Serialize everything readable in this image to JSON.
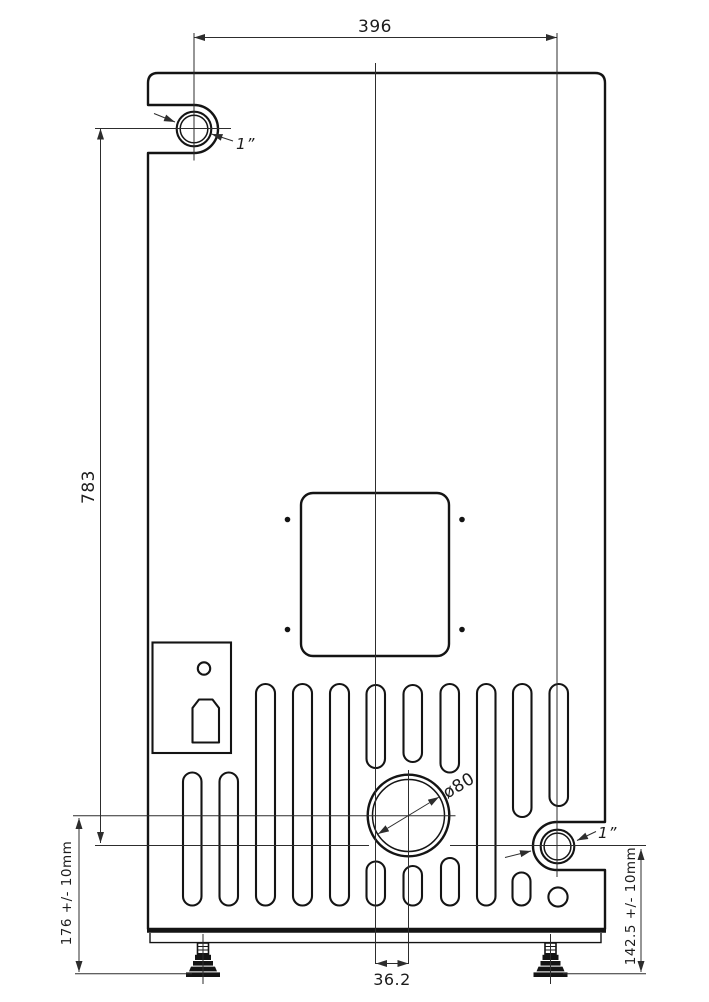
{
  "drawing": {
    "kind": "technical-dimension-drawing",
    "units": "mm",
    "colors": {
      "line": "#141414",
      "dimension_line": "#2d2d2d",
      "background": "#ffffff"
    },
    "dimensions": {
      "top_pipe_span": {
        "label": "396"
      },
      "pipe_vertical_span": {
        "label": "783"
      },
      "flue_center_to_floor": {
        "label": "176 +/- 10mm"
      },
      "pipe_center_to_floor": {
        "label": "142.5 +/- 10mm"
      },
      "flue_center_offset": {
        "label": "36.2"
      },
      "flue_diameter": {
        "label": "ø80"
      },
      "top_pipe_size": {
        "label": "1”"
      },
      "bottom_pipe_size": {
        "label": "1”"
      }
    }
  }
}
